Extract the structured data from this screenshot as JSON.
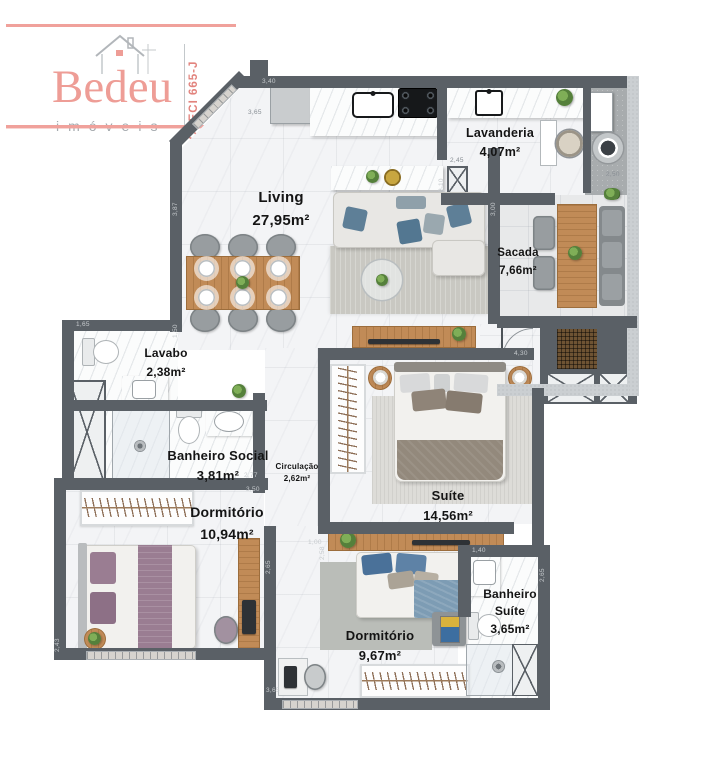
{
  "logo": {
    "brand": "Bedeu",
    "subtitle": "imóveis",
    "creci": "CRECI 665-J",
    "accent_pink": "#ee9d96",
    "gray": "#a4a9ad"
  },
  "palette": {
    "wall_dark": "#5a6066",
    "wall_light": "#cbcfd2",
    "floor": "#f3f4f6",
    "balcony_floor": "#e8e9ea",
    "service_floor": "#a8acae",
    "wood": "#c18b57",
    "pillow_blue": "#5e7f97",
    "bedding_purple": "#9a7d92",
    "bedding_taupe": "#93897c",
    "plant_green": "#55803b"
  },
  "rooms": [
    {
      "id": "living",
      "name": "Living",
      "area": "27,95m²"
    },
    {
      "id": "lavanderia",
      "name": "Lavanderia",
      "area": "4,07m²"
    },
    {
      "id": "sacada",
      "name": "Sacada",
      "area": "7,66m²"
    },
    {
      "id": "lavabo",
      "name": "Lavabo",
      "area": "2,38m²"
    },
    {
      "id": "banheiro-social",
      "name": "Banheiro Social",
      "area": "3,81m²"
    },
    {
      "id": "circulacao",
      "name": "Circulação",
      "area": "2,62m²"
    },
    {
      "id": "dormitorio-1",
      "name": "Dormitório",
      "area": "10,94m²"
    },
    {
      "id": "suite",
      "name": "Suíte",
      "area": "14,56m²"
    },
    {
      "id": "dormitorio-2",
      "name": "Dormitório",
      "area": "9,67m²"
    },
    {
      "id": "banheiro-suite",
      "name": "Banheiro\nSuíte",
      "area": "3,65m²"
    }
  ],
  "dimensions": [
    {
      "text": "3,40"
    },
    {
      "text": "3,65"
    },
    {
      "text": "3,87"
    },
    {
      "text": "1,50"
    },
    {
      "text": "1,65"
    },
    {
      "text": "2,45"
    },
    {
      "text": "2,10"
    },
    {
      "text": "3,00"
    },
    {
      "text": "2,50"
    },
    {
      "text": "4,30"
    },
    {
      "text": "2,77"
    },
    {
      "text": "3,50"
    },
    {
      "text": "2,65"
    },
    {
      "text": "2,43"
    },
    {
      "text": "1,00"
    },
    {
      "text": "2,58"
    },
    {
      "text": "1,40"
    },
    {
      "text": "2,65"
    },
    {
      "text": "3,65"
    }
  ],
  "furniture_icons": [
    "refrigerator-icon",
    "kitchen-sink-icon",
    "cooktop-icon",
    "island-counter-icon",
    "dining-table-icon",
    "sofa-icon",
    "coffee-table-icon",
    "tv-console-icon",
    "laundry-sink-icon",
    "washer-icon",
    "laundry-basket-icon",
    "balcony-table-icon",
    "grill-icon",
    "duct-shaft-icon",
    "entry-door-icon",
    "toilet-icon",
    "washbasin-icon",
    "shower-icon",
    "double-bed-icon",
    "nightstand-icon",
    "wardrobe-icon",
    "desk-icon",
    "desk-chair-icon",
    "plant-icon",
    "rug-icon"
  ]
}
